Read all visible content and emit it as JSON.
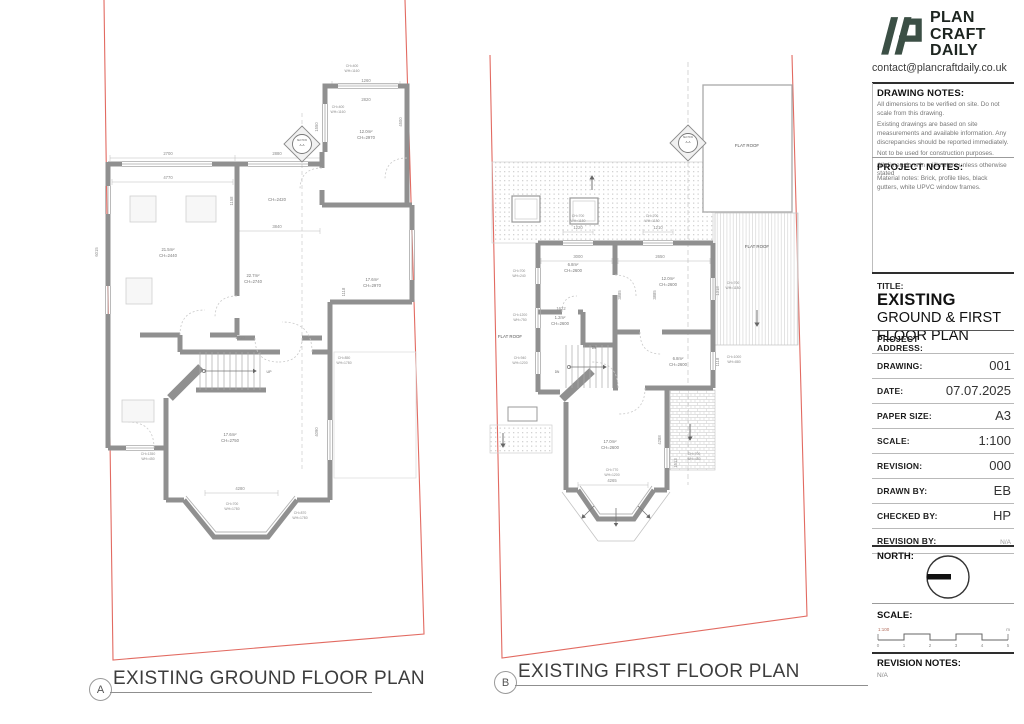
{
  "titleblock": {
    "brand": {
      "line1": "PLAN",
      "line2": "CRAFT",
      "line3": "DAILY"
    },
    "contact": "contact@plancraftdaily.co.uk",
    "drawing_notes": {
      "heading": "DRAWING NOTES:",
      "notes": [
        "All dimensions to be verified on site. Do not scale from this drawing.",
        "Existing drawings are based on site measurements and available information. Any discrepancies should be reported immediately.",
        "Not to be used for construction purposes.",
        "All dimensions in millimeters unless otherwise stated"
      ]
    },
    "project_notes": {
      "heading": "PROJECT NOTES:",
      "notes": [
        "Material notes: Brick, profile tiles, black gutters, white UPVC window frames."
      ]
    },
    "title_label": "TITLE:",
    "title_strong": "EXISTING",
    "title_rest": " GROUND & FIRST FLOOR PLAN",
    "fields": [
      {
        "label": "PROJECT ADDRESS:",
        "value": "",
        "addr": true
      },
      {
        "label": "DRAWING:",
        "value": "001"
      },
      {
        "label": "DATE:",
        "value": "07.07.2025"
      },
      {
        "label": "PAPER SIZE:",
        "value": "A3"
      },
      {
        "label": "SCALE:",
        "value": "1:100"
      },
      {
        "label": "REVISION:",
        "value": "000"
      },
      {
        "label": "DRAWN BY:",
        "value": "EB"
      },
      {
        "label": "CHECKED BY:",
        "value": "HP"
      },
      {
        "label": "REVISION BY:",
        "value": "N/A",
        "small": true
      }
    ],
    "north_label": "NORTH:",
    "scale_label": "SCALE:",
    "scale_bar": {
      "ratio": "1:100",
      "ticks": [
        "0",
        "1",
        "2",
        "3",
        "4",
        "5"
      ],
      "unit": "m"
    },
    "revision_notes": {
      "heading": "REVISION NOTES:",
      "value": "N/A"
    }
  },
  "plans": {
    "a": {
      "tag": "A",
      "caption": "EXISTING GROUND FLOOR PLAN",
      "texts": [
        {
          "x": 168,
          "y": 155,
          "t": "2700"
        },
        {
          "x": 277,
          "y": 155,
          "t": "2880"
        },
        {
          "x": 168,
          "y": 179,
          "t": "4770"
        },
        {
          "x": 366,
          "y": 82,
          "t": "1260"
        },
        {
          "x": 352,
          "y": 67,
          "t": "CH=400",
          "s": 3.4
        },
        {
          "x": 352,
          "y": 72,
          "t": "WH=1160",
          "s": 3.4
        },
        {
          "x": 338,
          "y": 108,
          "t": "CH=400",
          "s": 3.4
        },
        {
          "x": 338,
          "y": 113,
          "t": "WH=1160",
          "s": 3.4
        },
        {
          "x": 366,
          "y": 101,
          "t": "2820"
        },
        {
          "x": 318,
          "y": 127,
          "t": "1550",
          "r": -90
        },
        {
          "x": 402,
          "y": 122,
          "t": "4500",
          "r": -90
        },
        {
          "x": 366,
          "y": 133,
          "t": "12.0m²",
          "c": "#777",
          "n": "room-label"
        },
        {
          "x": 366,
          "y": 139,
          "t": "CH=2970",
          "c": "#777"
        },
        {
          "x": 277,
          "y": 201,
          "t": "CH=2420",
          "c": "#777"
        },
        {
          "x": 277,
          "y": 228,
          "t": "3840"
        },
        {
          "x": 233,
          "y": 201,
          "t": "1158",
          "r": -90
        },
        {
          "x": 168,
          "y": 251,
          "t": "21.5m²",
          "c": "#777",
          "n": "room-label"
        },
        {
          "x": 168,
          "y": 257,
          "t": "CH=2440",
          "c": "#777"
        },
        {
          "x": 253,
          "y": 277,
          "t": "22.7m²",
          "c": "#777",
          "n": "room-label"
        },
        {
          "x": 253,
          "y": 283,
          "t": "CH=2740",
          "c": "#777"
        },
        {
          "x": 372,
          "y": 281,
          "t": "17.6m²",
          "c": "#777",
          "n": "room-label"
        },
        {
          "x": 372,
          "y": 287,
          "t": "CH=2970",
          "c": "#777"
        },
        {
          "x": 345,
          "y": 292,
          "t": "1118",
          "r": -90
        },
        {
          "x": 98,
          "y": 252,
          "t": "6015",
          "r": -90
        },
        {
          "x": 344,
          "y": 359,
          "t": "CH=850",
          "s": 3.4
        },
        {
          "x": 344,
          "y": 364,
          "t": "WH=1780",
          "s": 3.4
        },
        {
          "x": 240,
          "y": 339,
          "t": "1010"
        },
        {
          "x": 269,
          "y": 373,
          "t": "UP",
          "s": 3.6,
          "c": "#666"
        },
        {
          "x": 230,
          "y": 436,
          "t": "17.6m²",
          "c": "#777",
          "n": "room-label"
        },
        {
          "x": 230,
          "y": 442,
          "t": "CH=2750",
          "c": "#777"
        },
        {
          "x": 318,
          "y": 432,
          "t": "4090",
          "r": -90
        },
        {
          "x": 240,
          "y": 490,
          "t": "4280"
        },
        {
          "x": 232,
          "y": 505,
          "t": "CH=700",
          "s": 3.4
        },
        {
          "x": 232,
          "y": 510,
          "t": "WH=1780",
          "s": 3.4
        },
        {
          "x": 148,
          "y": 455,
          "t": "CH=1350",
          "s": 3.4
        },
        {
          "x": 148,
          "y": 460,
          "t": "WH=450",
          "s": 3.4
        },
        {
          "x": 300,
          "y": 514,
          "t": "CH=870",
          "s": 3.4
        },
        {
          "x": 300,
          "y": 519,
          "t": "WH=1780",
          "s": 3.4
        },
        {
          "x": 302,
          "y": 141,
          "t": "SECTION",
          "s": 2.3,
          "c": "#666"
        },
        {
          "x": 302,
          "y": 146,
          "t": "A-A",
          "s": 3,
          "c": "#555"
        }
      ]
    },
    "b": {
      "tag": "B",
      "caption": "EXISTING FIRST FLOOR PLAN",
      "texts": [
        {
          "x": 578,
          "y": 229,
          "t": "1220"
        },
        {
          "x": 658,
          "y": 229,
          "t": "1210"
        },
        {
          "x": 578,
          "y": 217,
          "t": "CH=700",
          "s": 3.4
        },
        {
          "x": 578,
          "y": 222,
          "t": "WH=1180",
          "s": 3.4
        },
        {
          "x": 652,
          "y": 217,
          "t": "CH=700",
          "s": 3.4
        },
        {
          "x": 652,
          "y": 222,
          "t": "WH=1180",
          "s": 3.4
        },
        {
          "x": 578,
          "y": 258,
          "t": "3000"
        },
        {
          "x": 660,
          "y": 258,
          "t": "2650"
        },
        {
          "x": 573,
          "y": 266,
          "t": "6.8m²",
          "c": "#777",
          "n": "room-label"
        },
        {
          "x": 573,
          "y": 272,
          "t": "CH=2600",
          "c": "#777"
        },
        {
          "x": 668,
          "y": 280,
          "t": "12.0m²",
          "c": "#777",
          "n": "room-label"
        },
        {
          "x": 668,
          "y": 286,
          "t": "CH=2600",
          "c": "#777"
        },
        {
          "x": 621,
          "y": 295,
          "t": "3885",
          "r": -90
        },
        {
          "x": 656,
          "y": 295,
          "t": "3885",
          "r": -90
        },
        {
          "x": 719,
          "y": 291,
          "t": "1318",
          "r": -90
        },
        {
          "x": 733,
          "y": 284,
          "t": "CH=700",
          "s": 3.4
        },
        {
          "x": 733,
          "y": 289,
          "t": "WH=1180",
          "s": 3.4
        },
        {
          "x": 561,
          "y": 310,
          "t": "1622"
        },
        {
          "x": 560,
          "y": 319,
          "t": "1.2m²",
          "c": "#777",
          "n": "room-label"
        },
        {
          "x": 560,
          "y": 325,
          "t": "CH=2600",
          "c": "#777"
        },
        {
          "x": 519,
          "y": 272,
          "t": "CH=700",
          "s": 3.4
        },
        {
          "x": 519,
          "y": 277,
          "t": "WH=240",
          "s": 3.4
        },
        {
          "x": 520,
          "y": 316,
          "t": "CH=1200",
          "s": 3.4
        },
        {
          "x": 520,
          "y": 321,
          "t": "WH=750",
          "s": 3.4
        },
        {
          "x": 520,
          "y": 359,
          "t": "CH=940",
          "s": 3.4
        },
        {
          "x": 520,
          "y": 364,
          "t": "WH=1200",
          "s": 3.4
        },
        {
          "x": 510,
          "y": 338,
          "t": "FLAT ROOF",
          "s": 4.4,
          "c": "#555",
          "n": "flat-roof-label"
        },
        {
          "x": 678,
          "y": 360,
          "t": "6.8m²",
          "c": "#777",
          "n": "room-label"
        },
        {
          "x": 678,
          "y": 366,
          "t": "CH=2600",
          "c": "#777"
        },
        {
          "x": 719,
          "y": 362,
          "t": "1118",
          "r": -90
        },
        {
          "x": 734,
          "y": 358,
          "t": "CH=1000",
          "s": 3.4
        },
        {
          "x": 734,
          "y": 363,
          "t": "WH=880",
          "s": 3.4
        },
        {
          "x": 594,
          "y": 349,
          "t": "DN",
          "s": 3.2,
          "c": "#666"
        },
        {
          "x": 557,
          "y": 373,
          "t": "DN",
          "s": 3.2,
          "c": "#666"
        },
        {
          "x": 610,
          "y": 443,
          "t": "17.0m²",
          "c": "#777",
          "n": "room-label"
        },
        {
          "x": 610,
          "y": 449,
          "t": "CH=2600",
          "c": "#777"
        },
        {
          "x": 661,
          "y": 440,
          "t": "4288",
          "r": -90
        },
        {
          "x": 677,
          "y": 463,
          "t": "1513",
          "r": -90
        },
        {
          "x": 694,
          "y": 455,
          "t": "CH=700",
          "s": 3.4
        },
        {
          "x": 694,
          "y": 460,
          "t": "WH=450",
          "s": 3.4
        },
        {
          "x": 612,
          "y": 471,
          "t": "CH=770",
          "s": 3.4
        },
        {
          "x": 612,
          "y": 476,
          "t": "WH=1200",
          "s": 3.4
        },
        {
          "x": 612,
          "y": 482,
          "t": "4265"
        },
        {
          "x": 747,
          "y": 147,
          "t": "FLAT ROOF",
          "s": 4.4,
          "c": "#555",
          "n": "flat-roof-label"
        },
        {
          "x": 757,
          "y": 248,
          "t": "FLAT ROOF",
          "s": 4.4,
          "c": "#555",
          "n": "flat-roof-label"
        },
        {
          "x": 688,
          "y": 138,
          "t": "SECTION",
          "s": 2.3,
          "c": "#666"
        },
        {
          "x": 688,
          "y": 143,
          "t": "A-A",
          "s": 3,
          "c": "#555"
        }
      ]
    }
  },
  "colors": {
    "boundary": "#df5a50",
    "wall": "#909090",
    "accent_green": "#3b4f45"
  }
}
